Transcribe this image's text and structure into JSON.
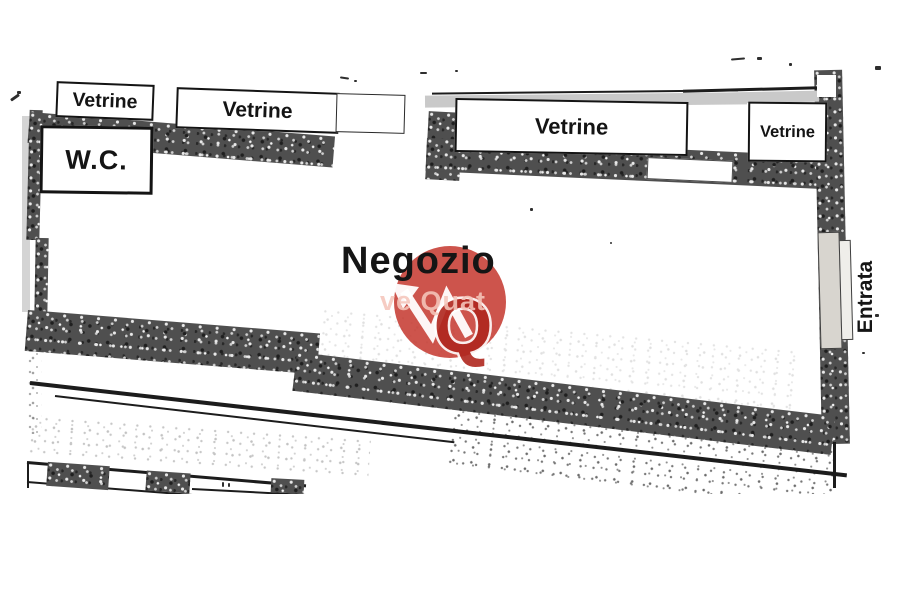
{
  "plan": {
    "shop_label": "Negozio",
    "wc_label": "W.C.",
    "entrance_label": "Entrata",
    "windows": [
      {
        "label": "Vetrine"
      },
      {
        "label": "Vetrine"
      },
      {
        "label": "Vetrine"
      },
      {
        "label": "Vetrine"
      }
    ]
  },
  "watermark": {
    "visible_text": "ve Quat",
    "monogram_letter": "Q",
    "logo": "red-circle-arrow-q-monogram",
    "circle_color": "#c5382f",
    "monogram_color": "#b0271f",
    "text_color": "#f5c6bb"
  },
  "colors": {
    "paper": "#ffffff",
    "wall_fill": "#4f4f4f",
    "ink": "#141414",
    "sill_gray": "#c9c9c9",
    "door_leaf_light": "#d8d5cf",
    "door_leaf_lighter": "#efeeea"
  }
}
